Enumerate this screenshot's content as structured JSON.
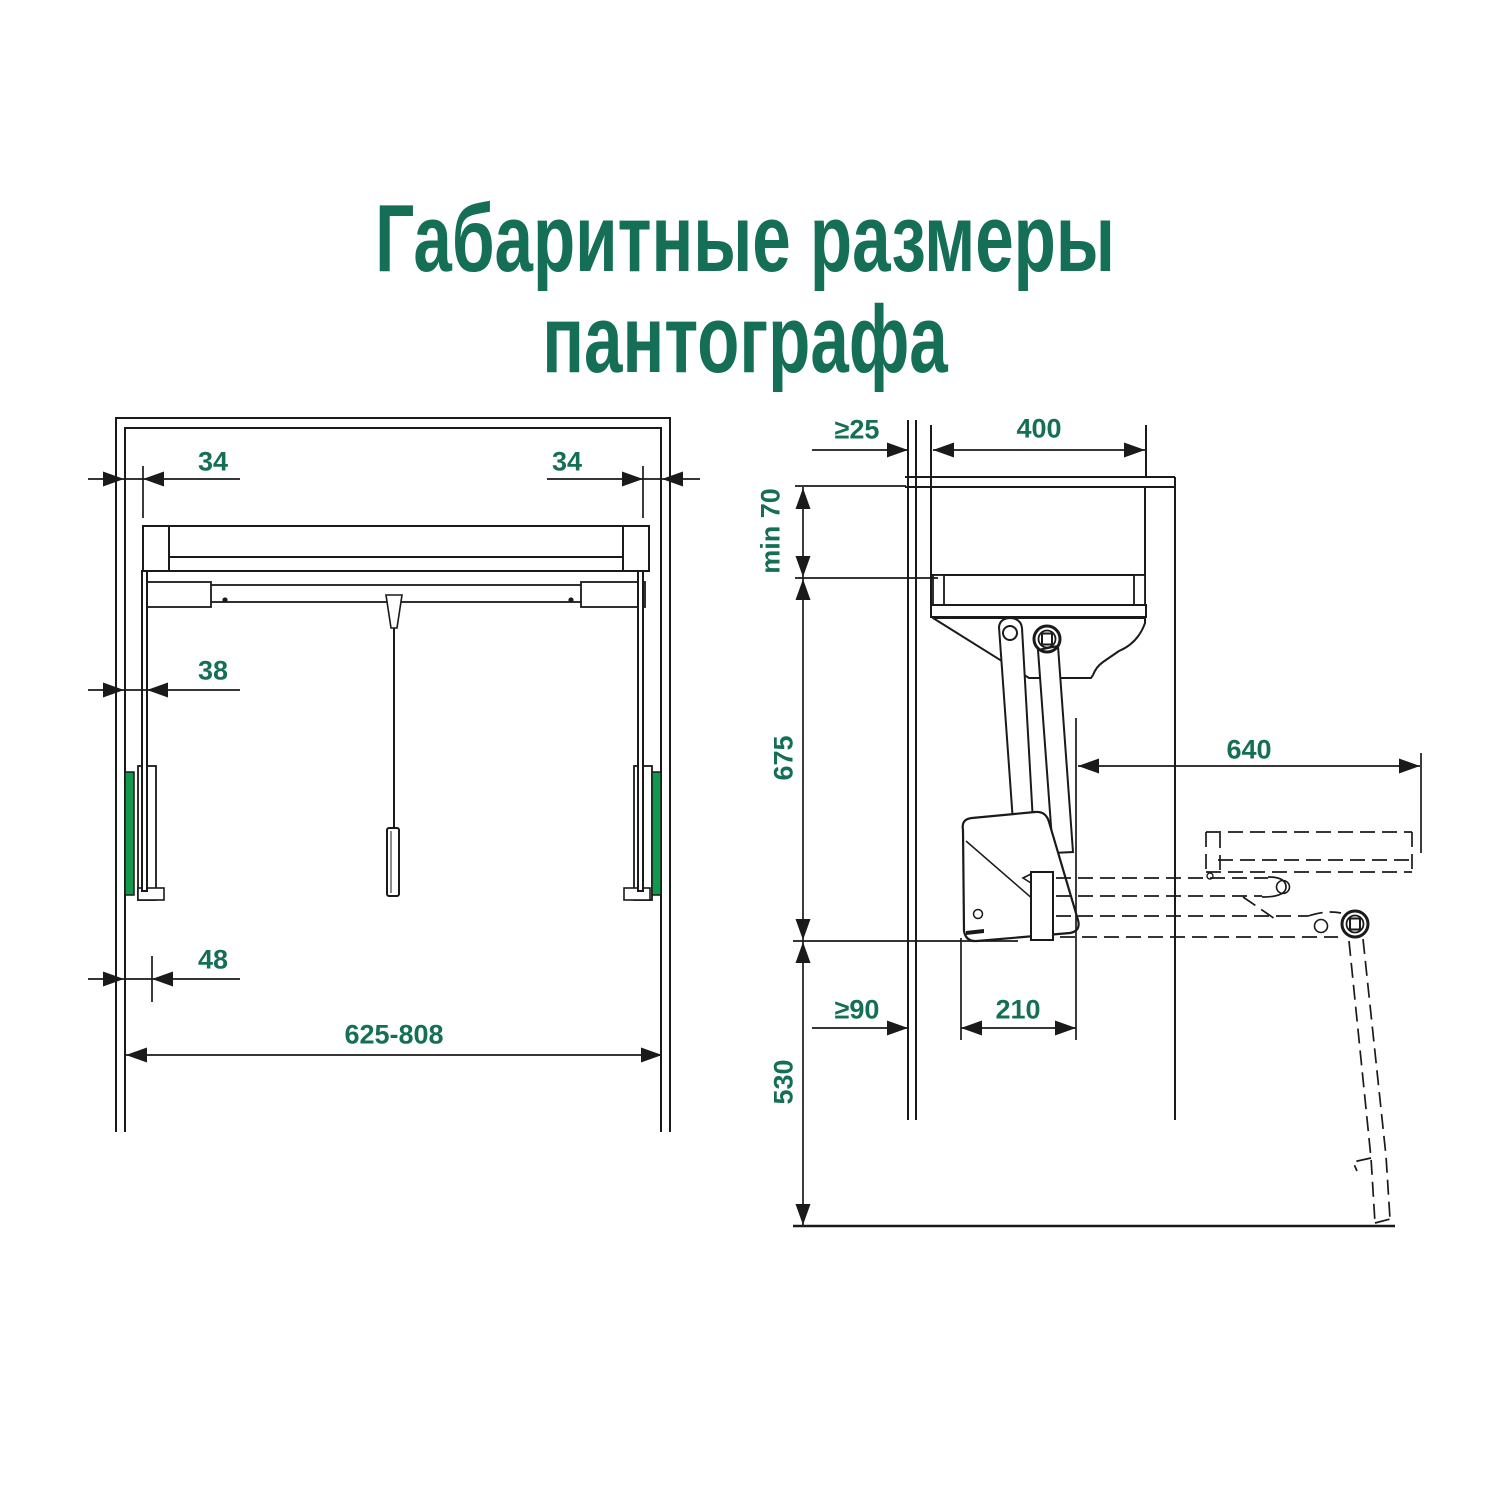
{
  "title": {
    "line1": "Габаритные размеры",
    "line2": "пантографа"
  },
  "colors": {
    "accent_text_green": "#156F56",
    "strip_green": "#119A4E",
    "line_black": "#1A1A1A",
    "background": "#FFFFFF"
  },
  "front_view": {
    "name": "Пантограф — вид спереди",
    "reveal_left": "34",
    "reveal_right": "34",
    "rail_inset": "38",
    "bracket_width": "48",
    "width_range": "625-808"
  },
  "side_view": {
    "name": "Пантограф — вид сбоку",
    "back_gap": "≥25",
    "cabinet_depth": "400",
    "top_clearance": "min 70",
    "body_height": "675",
    "arm_extension": "640",
    "front_gap": "≥90",
    "mechanism_depth": "210",
    "floor_clearance": "530"
  }
}
